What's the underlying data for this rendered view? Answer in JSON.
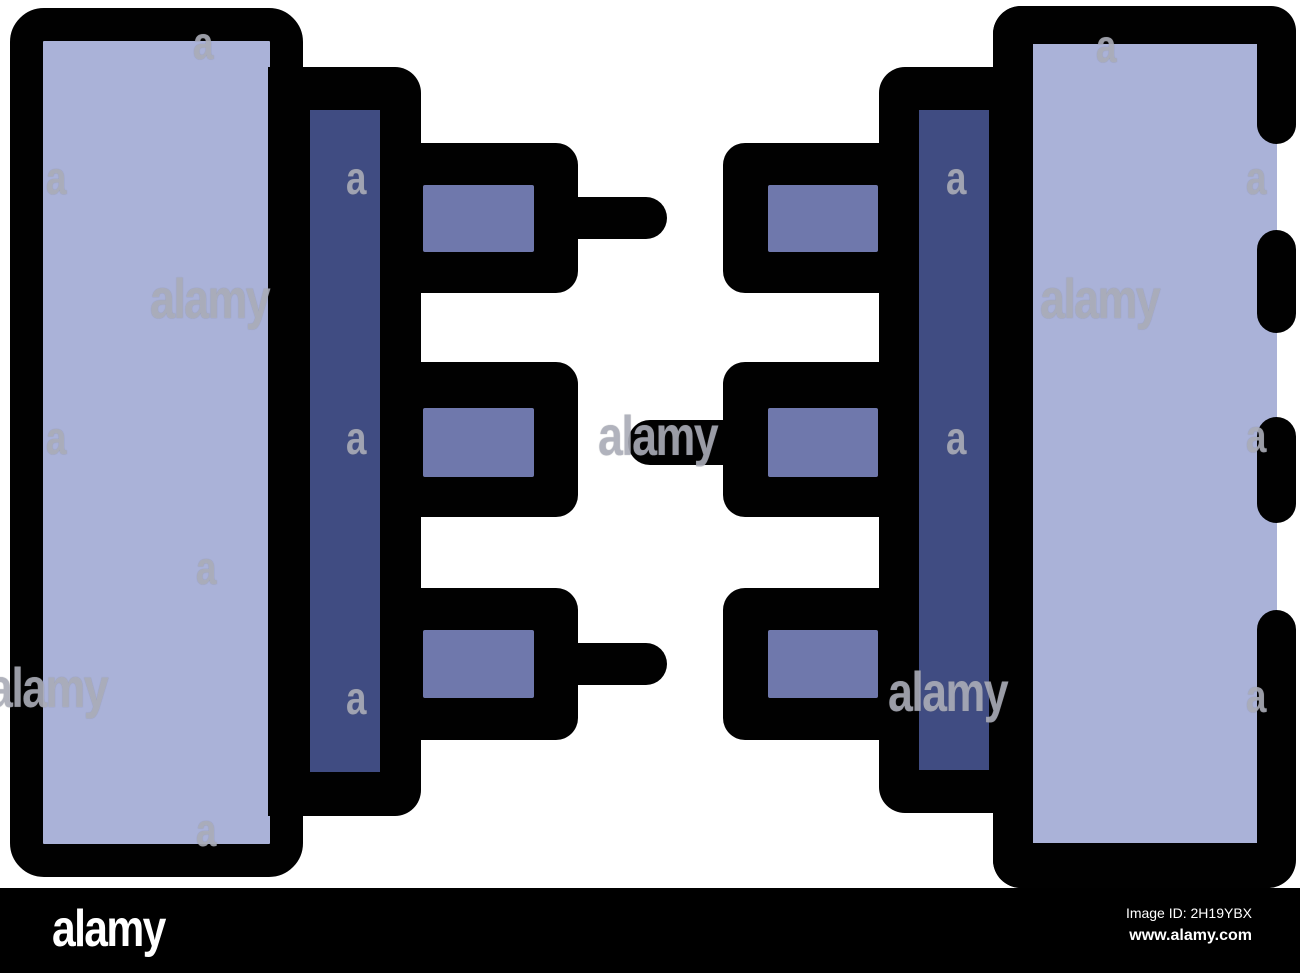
{
  "image": {
    "title": "Disconnected connectors icon, color outline style",
    "background": "#ffffff"
  },
  "icon": {
    "name": "disconnected-connectors-icon",
    "colors": {
      "outline": "#010101",
      "block_fill": "#aab2d8",
      "bar_fill": "#404c82",
      "pin_fill": "#6f78ac"
    }
  },
  "watermark": {
    "word": "alamy",
    "letter": "a",
    "color": "rgba(178,180,192,0.8)",
    "word_positions": [
      {
        "x": 150,
        "y": 271
      },
      {
        "x": 1040,
        "y": 271
      },
      {
        "x": 598,
        "y": 408
      },
      {
        "x": -12,
        "y": 660
      },
      {
        "x": 888,
        "y": 664
      }
    ],
    "letter_positions": [
      {
        "x": 193,
        "y": 20
      },
      {
        "x": 1096,
        "y": 23
      },
      {
        "x": 46,
        "y": 155
      },
      {
        "x": 346,
        "y": 155
      },
      {
        "x": 946,
        "y": 155
      },
      {
        "x": 1246,
        "y": 155
      },
      {
        "x": 46,
        "y": 415
      },
      {
        "x": 346,
        "y": 415
      },
      {
        "x": 946,
        "y": 415
      },
      {
        "x": 1246,
        "y": 413
      },
      {
        "x": 196,
        "y": 545
      },
      {
        "x": 346,
        "y": 675
      },
      {
        "x": 1246,
        "y": 673
      },
      {
        "x": 196,
        "y": 807
      }
    ]
  },
  "footer": {
    "logo": "alamy",
    "image_id": "Image ID: 2H19YBX",
    "website": "www.alamy.com",
    "bg": "#000000",
    "text_color": "#ffffff"
  }
}
